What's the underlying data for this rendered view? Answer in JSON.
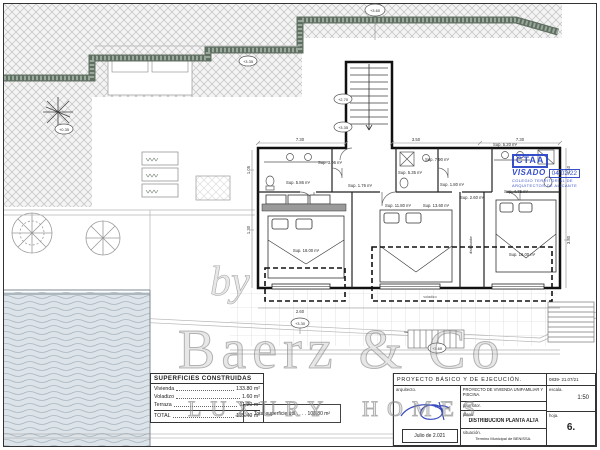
{
  "watermark": {
    "by": "by",
    "brand": "Baerz & Co",
    "tagline": "LUXURY HOMES"
  },
  "stamp": {
    "org": "CTAA",
    "label": "VISADO",
    "date": "04/02/22",
    "line1": "COLEGIO TERRITORIAL DE",
    "line2": "ARQUITECTOS DE ALICANTE",
    "color": "#2742c6"
  },
  "areas_table": {
    "title": "SUPERFICIES CONSTRUIDAS",
    "rows": [
      {
        "label": "Vivienda",
        "value": "133.80 m²"
      },
      {
        "label": "Voladizo",
        "value": "1.60 m²"
      },
      {
        "label": "Terraza",
        "value": "11.20 m²"
      },
      {
        "label": "TOTAL",
        "value": "135.40 m²"
      }
    ],
    "useful_area": "Total superficie útil . . . . 108.80 m²"
  },
  "title_block": {
    "project_type": "PROYECTO BÁSICO Y DE EJECUCIÓN.",
    "file_number": "0839- 21.07/21",
    "architect_label": "arquitecto.",
    "date": "Julio de 2.021",
    "project_desc": "PROYECTO DE VIVIENDA UNIFAMILIAR Y PISCINA.",
    "promoter_label": "promotor.",
    "plan_label": "plano.",
    "plan_title": "DISTRIBUCION PLANTA ALTA",
    "location_label": "situación.",
    "location": "Termino Municipal de BENISSA.",
    "scale_label": "escala.",
    "scale": "1:50",
    "sheet_label": "hoja.",
    "sheet": "6."
  },
  "plan": {
    "room_labels": [
      "Sup. 3.06 m²",
      "Sup. 5.86 m²",
      "Sup. 1.76 m²",
      "Sup. 18.00 m²",
      "Sup. 5.35 m²",
      "Sup. 7.90 m²",
      "Sup. 2.60 m²",
      "Sup. 1.80 m²",
      "Sup. 5.20 m²",
      "Sup. 4.75 m²",
      "Sup. 11.80 m²",
      "Sup. 13.60 m²",
      "Sup. 16.00 m²"
    ],
    "corridor_label": "distribuidor",
    "balcony_label": "voladizo",
    "dimensions": [
      "7.30",
      "3.50",
      "7.30",
      "1.05",
      "1.30",
      "1.40",
      "3.80",
      "2.60"
    ],
    "level_markers": [
      "+3.60",
      "+3.35",
      "+2.70",
      "+3.35",
      "+0.35",
      "+3.30",
      "+3.60"
    ]
  }
}
